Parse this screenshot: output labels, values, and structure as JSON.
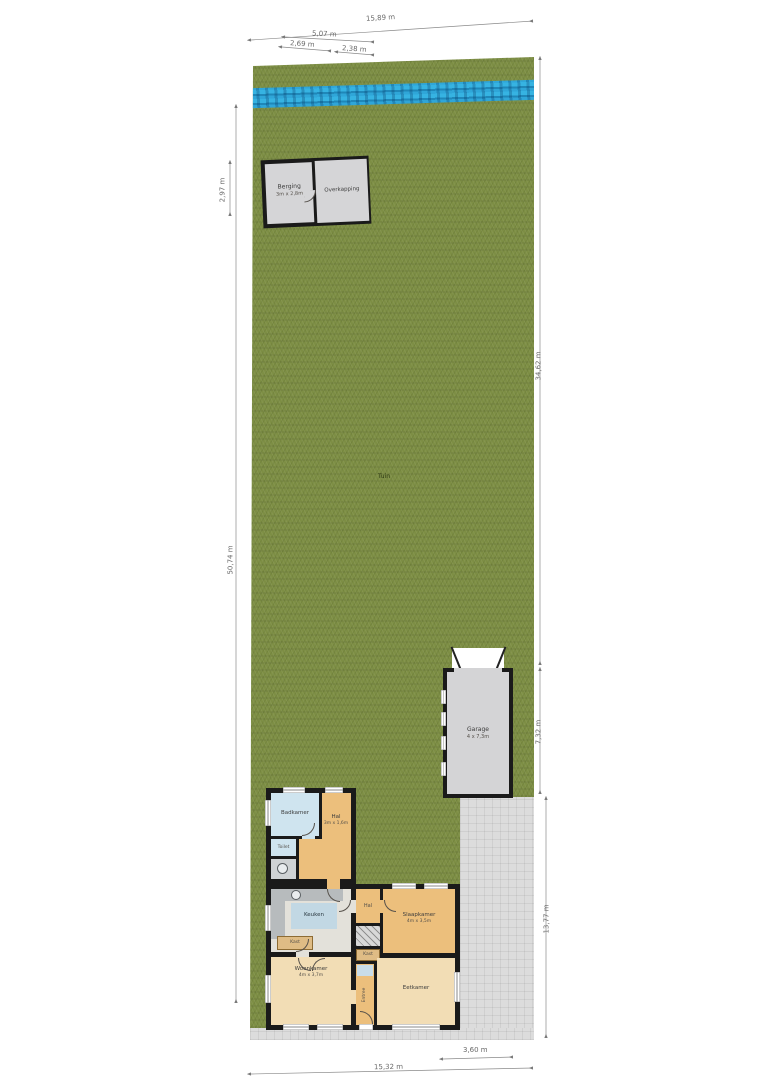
{
  "plan_type": "site-plan-floor-plan",
  "labels": {
    "tuin": "Tuin",
    "berging": "Berging",
    "berging_dims": "3m x 2,8m",
    "overkapping": "Overkapping",
    "garage": "Garage",
    "garage_dims": "4 x 7,3m",
    "badkamer": "Badkamer",
    "hal_noord": "Hal",
    "hal_noord_dims": "3m x 1,6m",
    "toilet": "Toilet",
    "keuken": "Keuken",
    "kast_keuken": "Kast",
    "hal_zuid": "Hal",
    "kast_zuid": "Kast",
    "slaapkamer": "Slaapkamer",
    "slaapkamer_dims": "4m x 3,5m",
    "woonkamer": "Woonkamer",
    "woonkamer_dims": "4m x 3,7m",
    "eetkamer": "Eetkamer",
    "entree": "Entree"
  },
  "dimensions": {
    "top_total": "15,89 m",
    "top_shed_total": "5,07 m",
    "top_shed_left": "2,69 m",
    "top_shed_right": "2,38 m",
    "left_shed_height": "2,97 m",
    "left_total": "50,74 m",
    "right_upper": "34,62 m",
    "right_garage": "7,32 m",
    "right_lower": "13,77 m",
    "bottom_garage_width": "3,60 m",
    "bottom_total": "15,32 m"
  },
  "colors": {
    "grass": "#7D8E44",
    "water": "#2FA6D8",
    "wall": "#1A1A1A",
    "building_gray": "#D5D5D7",
    "room_orange": "#ECBF7C",
    "room_cream": "#F2DDB5",
    "room_blue": "#CFE4EF",
    "paving": "#DCDCDC"
  }
}
